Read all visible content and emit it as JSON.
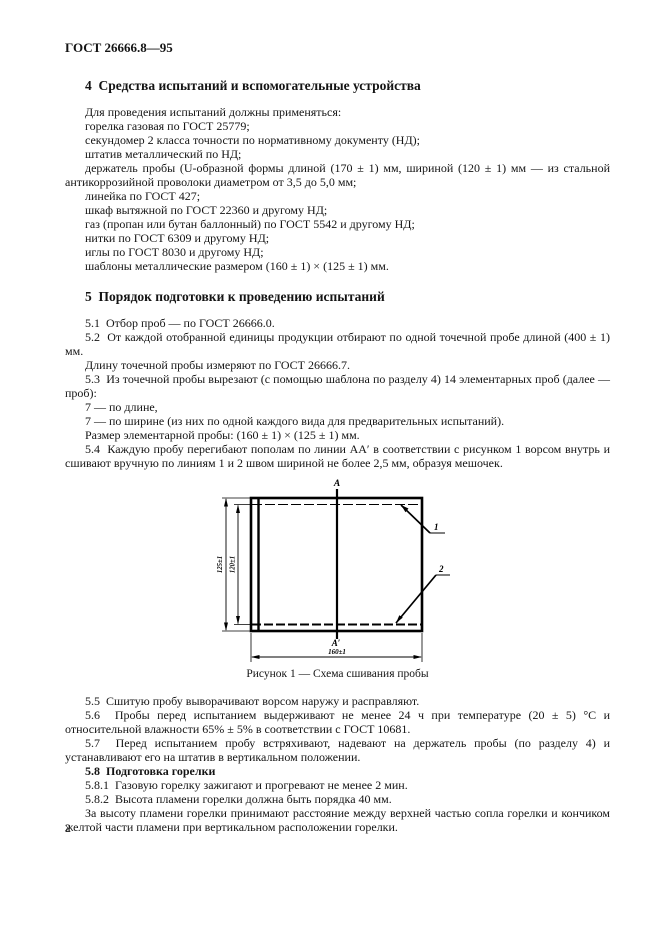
{
  "doc_header": "ГОСТ 26666.8—95",
  "page_number": "2",
  "section4": {
    "title": "4  Средства испытаний и вспомогательные устройства",
    "intro": "Для проведения испытаний должны применяться:",
    "items": [
      "горелка газовая по ГОСТ 25779;",
      "секундомер 2 класса точности по нормативному документу (НД);",
      "штатив металлический по НД;",
      "держатель пробы (U-образной формы длиной (170 ± 1) мм, шириной (120 ± 1) мм — из стальной антикоррозийной проволоки диаметром от 3,5 до 5,0 мм;",
      "линейка по ГОСТ 427;",
      "шкаф вытяжной по ГОСТ 22360 и другому НД;",
      "газ (пропан или бутан баллонный) по ГОСТ 5542 и другому НД;",
      "нитки по ГОСТ 6309 и другому НД;",
      "иглы по ГОСТ 8030 и другому НД;",
      "шаблоны металлические размером (160 ± 1) × (125 ± 1) мм."
    ]
  },
  "section5": {
    "title": "5  Порядок подготовки к проведению испытаний",
    "p51": "5.1  Отбор проб — по ГОСТ 26666.0.",
    "p52": "5.2  От каждой отобранной единицы продукции отбирают по одной точечной пробе длиной (400 ± 1) мм.",
    "p52a": "Длину точечной пробы измеряют по ГОСТ 26666.7.",
    "p53": "5.3  Из точечной пробы вырезают (с помощью шаблона по разделу 4) 14 элементарных проб (далее — проб):",
    "p53_len": "7 — по длине,",
    "p53_wid": "7 — по ширине (из них по одной каждого вида для предварительных испытаний).",
    "p53_size": "Размер элементарной пробы: (160 ± 1) × (125 ± 1) мм.",
    "p54": "5.4  Каждую пробу перегибают пополам по линии AA′ в соответствии с рисунком 1 ворсом внутрь и сшивают вручную по линиям 1 и 2 швом шириной не более 2,5 мм, образуя мешочек.",
    "p55": "5.5  Сшитую пробу выворачивают ворсом наружу и расправляют.",
    "p56": "5.6  Пробы перед испытанием выдерживают не менее 24 ч при температуре (20 ± 5) °С и относительной влажности 65% ± 5% в соответствии с ГОСТ 10681.",
    "p57": "5.7  Перед испытанием пробу встряхивают, надевают на держатель пробы (по разделу 4) и устанавливают его на штатив в вертикальном положении.",
    "p58": "5.8  Подготовка горелки",
    "p581": "5.8.1  Газовую горелку зажигают и прогревают не менее 2 мин.",
    "p582": "5.8.2  Высота пламени горелки должна быть порядка 40 мм.",
    "p58_note": "За высоту пламени горелки принимают расстояние между верхней частью сопла горелки и кончиком желтой части пламени при вертикальном расположении горелки."
  },
  "figure": {
    "point_a": "A",
    "point_a_prime": "A′",
    "seam_1": "1",
    "seam_2": "2",
    "dim_height_outer": "125±1",
    "dim_height_inner": "120±1",
    "dim_width": "160±1",
    "caption": "Рисунок 1 — Схема сшивания пробы"
  }
}
